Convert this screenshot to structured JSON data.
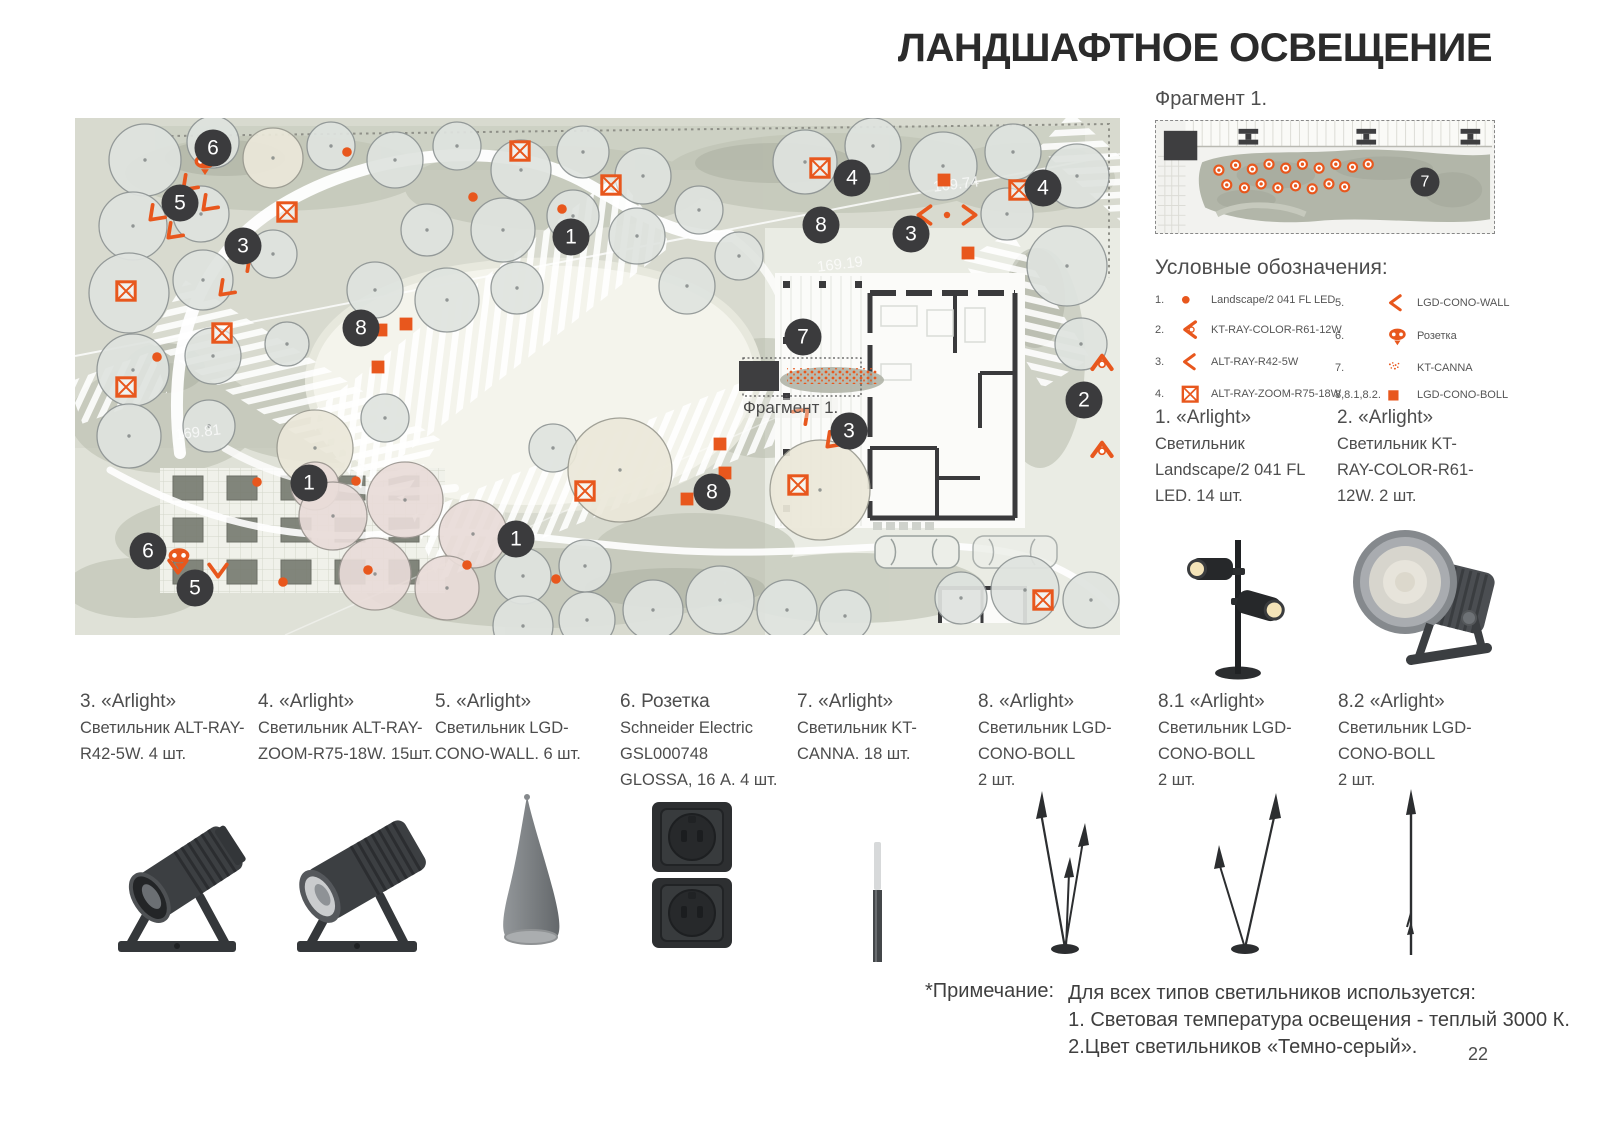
{
  "page": {
    "title": "ЛАНДШАФТНОЕ ОСВЕЩЕНИЕ",
    "number": "22"
  },
  "colors": {
    "accent": "#E8571D",
    "badge_bg": "#3B3B3D",
    "text": "#4D4D4D"
  },
  "fragment": {
    "label": "Фрагмент 1.",
    "badge": "7"
  },
  "map": {
    "fragment_label": "Фрагмент 1.",
    "elevation_labels": [
      {
        "text": "169.19",
        "x": 742,
        "y": 138
      },
      {
        "text": "169.81",
        "x": 100,
        "y": 306
      },
      {
        "text": "169.74",
        "x": 858,
        "y": 58
      }
    ],
    "badges": [
      {
        "n": "6",
        "x": 138,
        "y": 30
      },
      {
        "n": "5",
        "x": 105,
        "y": 85
      },
      {
        "n": "3",
        "x": 168,
        "y": 128
      },
      {
        "n": "1",
        "x": 496,
        "y": 119
      },
      {
        "n": "8",
        "x": 286,
        "y": 210
      },
      {
        "n": "4",
        "x": 777,
        "y": 60
      },
      {
        "n": "8",
        "x": 746,
        "y": 107
      },
      {
        "n": "3",
        "x": 836,
        "y": 116
      },
      {
        "n": "4",
        "x": 968,
        "y": 70
      },
      {
        "n": "7",
        "x": 728,
        "y": 219
      },
      {
        "n": "2",
        "x": 1009,
        "y": 282
      },
      {
        "n": "3",
        "x": 774,
        "y": 313
      },
      {
        "n": "1",
        "x": 234,
        "y": 365
      },
      {
        "n": "8",
        "x": 637,
        "y": 374
      },
      {
        "n": "1",
        "x": 441,
        "y": 421
      },
      {
        "n": "6",
        "x": 73,
        "y": 433
      },
      {
        "n": "5",
        "x": 120,
        "y": 470
      }
    ],
    "markers": [
      {
        "t": "xsquare",
        "x": 445,
        "y": 33
      },
      {
        "t": "xsquare",
        "x": 536,
        "y": 67
      },
      {
        "t": "xsquare",
        "x": 745,
        "y": 50
      },
      {
        "t": "xsquare",
        "x": 944,
        "y": 72
      },
      {
        "t": "xsquare",
        "x": 212,
        "y": 94
      },
      {
        "t": "xsquare",
        "x": 51,
        "y": 173
      },
      {
        "t": "xsquare",
        "x": 147,
        "y": 215
      },
      {
        "t": "xsquare",
        "x": 51,
        "y": 269
      },
      {
        "t": "xsquare",
        "x": 510,
        "y": 373
      },
      {
        "t": "xsquare",
        "x": 723,
        "y": 367
      },
      {
        "t": "xsquare",
        "x": 968,
        "y": 482
      },
      {
        "t": "square",
        "x": 869,
        "y": 62
      },
      {
        "t": "square",
        "x": 742,
        "y": 100
      },
      {
        "t": "square",
        "x": 893,
        "y": 135
      },
      {
        "t": "square",
        "x": 306,
        "y": 212
      },
      {
        "t": "square",
        "x": 331,
        "y": 206
      },
      {
        "t": "square",
        "x": 303,
        "y": 249
      },
      {
        "t": "square",
        "x": 645,
        "y": 326
      },
      {
        "t": "square",
        "x": 650,
        "y": 355
      },
      {
        "t": "square",
        "x": 612,
        "y": 381
      },
      {
        "t": "dot",
        "x": 272,
        "y": 34
      },
      {
        "t": "dot",
        "x": 398,
        "y": 79
      },
      {
        "t": "dot",
        "x": 487,
        "y": 91
      },
      {
        "t": "dot",
        "x": 82,
        "y": 239
      },
      {
        "t": "dot",
        "x": 182,
        "y": 364
      },
      {
        "t": "dot",
        "x": 281,
        "y": 363
      },
      {
        "t": "dot",
        "x": 208,
        "y": 464
      },
      {
        "t": "dot",
        "x": 293,
        "y": 452
      },
      {
        "t": "dot",
        "x": 392,
        "y": 447
      },
      {
        "t": "dot",
        "x": 481,
        "y": 461
      },
      {
        "t": "dot",
        "x": 872,
        "y": 97,
        "s": 8
      },
      {
        "t": "arrow",
        "x": 113,
        "y": 67,
        "r": -45
      },
      {
        "t": "arrow",
        "x": 133,
        "y": 87,
        "r": -45
      },
      {
        "t": "arrow",
        "x": 80,
        "y": 97,
        "r": -45
      },
      {
        "t": "arrow",
        "x": 98,
        "y": 115,
        "r": -45
      },
      {
        "t": "arrow",
        "x": 170,
        "y": 143,
        "r": 135
      },
      {
        "t": "arrow",
        "x": 150,
        "y": 172,
        "r": -45
      },
      {
        "t": "arrow",
        "x": 850,
        "y": 97,
        "r": 0
      },
      {
        "t": "arrow",
        "x": 894,
        "y": 97,
        "r": 180
      },
      {
        "t": "arrow",
        "x": 728,
        "y": 296,
        "r": 135
      },
      {
        "t": "arrow",
        "x": 757,
        "y": 324,
        "r": -45
      },
      {
        "t": "arrow",
        "x": 103,
        "y": 448,
        "r": -90
      },
      {
        "t": "arrow",
        "x": 143,
        "y": 452,
        "r": -90
      },
      {
        "t": "arrowdot",
        "x": 1027,
        "y": 245,
        "r": 90
      },
      {
        "t": "arrowdot",
        "x": 1027,
        "y": 332,
        "r": 90
      },
      {
        "t": "socket",
        "x": 130,
        "y": 46
      },
      {
        "t": "socket",
        "x": 104,
        "y": 440
      }
    ]
  },
  "legend": {
    "title": "Условные обозначения:",
    "items": [
      {
        "num": "1.",
        "icon": "dot",
        "label": "Landscape/2 041 FL LED"
      },
      {
        "num": "2.",
        "icon": "arrowdot",
        "label": "KT-RAY-COLOR-R61-12W"
      },
      {
        "num": "3.",
        "icon": "arrow",
        "label": "ALT-RAY-R42-5W"
      },
      {
        "num": "4.",
        "icon": "xsquare",
        "label": "ALT-RAY-ZOOM-R75-18W"
      },
      {
        "num": "5.",
        "icon": "arrow",
        "label": "LGD-CONO-WALL"
      },
      {
        "num": "6.",
        "icon": "socket",
        "label": "Розетка"
      },
      {
        "num": "7.",
        "icon": "speckles",
        "label": "KT-CANNA"
      },
      {
        "num": "8,8.1,8.2.",
        "icon": "square",
        "label": "LGD-CONO-BOLL"
      }
    ]
  },
  "products": [
    {
      "id": "1",
      "lines": [
        "1. «Arlight»",
        "Светильник",
        "Landscape/2 041 FL",
        "LED.  14 шт."
      ]
    },
    {
      "id": "2",
      "lines": [
        "2. «Arlight»",
        "Светильник KT-",
        "RAY-COLOR-R61-",
        "12W.  2 шт."
      ]
    },
    {
      "id": "3",
      "lines": [
        "3. «Arlight»",
        "Светильник ALT-RAY-",
        "R42-5W.  4 шт.",
        ""
      ]
    },
    {
      "id": "4",
      "lines": [
        "4. «Arlight»",
        "Светильник ALT-RAY-",
        "ZOOM-R75-18W. 15шт.",
        ""
      ]
    },
    {
      "id": "5",
      "lines": [
        "5. «Arlight»",
        "Светильник LGD-",
        "CONO-WALL. 6 шт.",
        ""
      ]
    },
    {
      "id": "6",
      "lines": [
        "6. Розетка",
        "Schneider Electric",
        "GSL000748",
        "GLOSSA, 16 А. 4 шт."
      ]
    },
    {
      "id": "7",
      "lines": [
        "7. «Arlight»",
        "Светильник KT-",
        "CANNA. 18 шт.",
        ""
      ]
    },
    {
      "id": "8",
      "lines": [
        "8. «Arlight»",
        "Светильник LGD-",
        "CONO-BOLL",
        "2 шт."
      ]
    },
    {
      "id": "8.1",
      "lines": [
        "8.1 «Arlight»",
        "Светильник LGD-",
        "CONO-BOLL",
        "2 шт."
      ]
    },
    {
      "id": "8.2",
      "lines": [
        "8.2 «Arlight»",
        "Светильник LGD-",
        "CONO-BOLL",
        "2 шт."
      ]
    }
  ],
  "note": {
    "label": "*Примечание:",
    "lines": [
      "Для всех типов светильников используется:",
      "1. Световая температура освещения - теплый 3000 К.",
      "2.Цвет светильников «Темно-серый»."
    ]
  }
}
